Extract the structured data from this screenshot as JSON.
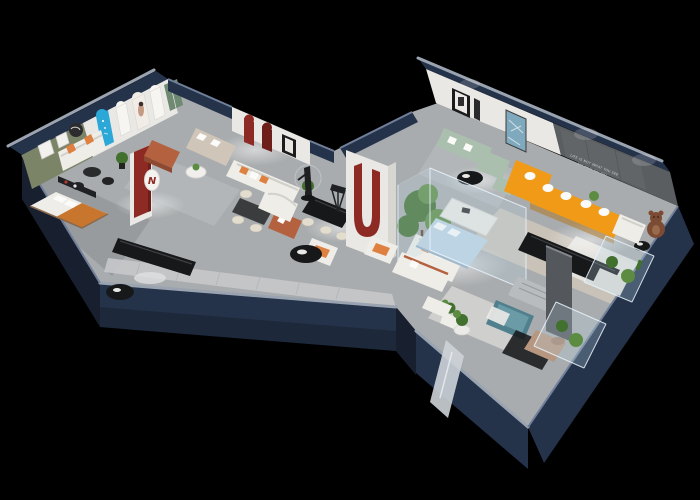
{
  "scene": {
    "wall_slogan": {
      "line1": "LIFE IS NOT WHAT YOU SEE",
      "line2": "BUT WHAT YOU FEEL"
    },
    "display_sign": {
      "letter": "N"
    }
  },
  "colors": {
    "background": "#000000",
    "outer_wall": "#24324a",
    "outer_wall_dark": "#18202f",
    "outer_wall_light": "#31415c",
    "interior_wall": "#eae8e4",
    "olive_wall": "#7c8468",
    "slogan_wall": "#5b5e61",
    "gray_panel": "#54575b",
    "floor": "#a9acae",
    "floor_dark": "#96999c",
    "walkway": "#c6c8ca",
    "rug_beige": "#cfc8ba",
    "rug_gray": "#bcc0c4",
    "rug_white": "#e9e7e3",
    "orange_sofa": "#f19a17",
    "orange_pillow": "#dd8040",
    "sage_sofa": "#aabfae",
    "light_blue": "#bdd3e2",
    "teal_bench": "#50808d",
    "terracotta": "#b4613f",
    "red_accent": "#8e2a24",
    "red_deep": "#6e1f1a",
    "blue_decal": "#2ba7d8",
    "green_door": "#6f8a72",
    "bear_brown": "#7c4b33",
    "tan_chaise": "#b89780",
    "mirror": "#cdd3d8",
    "blanket_orange": "#c8762e",
    "beige_sofa": "#cfc5b8",
    "gray_bed": "#b9bcbf",
    "black_furniture": "#17181a",
    "white_furniture": "#efede8",
    "cream": "#e3ddcf",
    "plant": "#41702f",
    "art_blue": "#7fa9bd"
  }
}
